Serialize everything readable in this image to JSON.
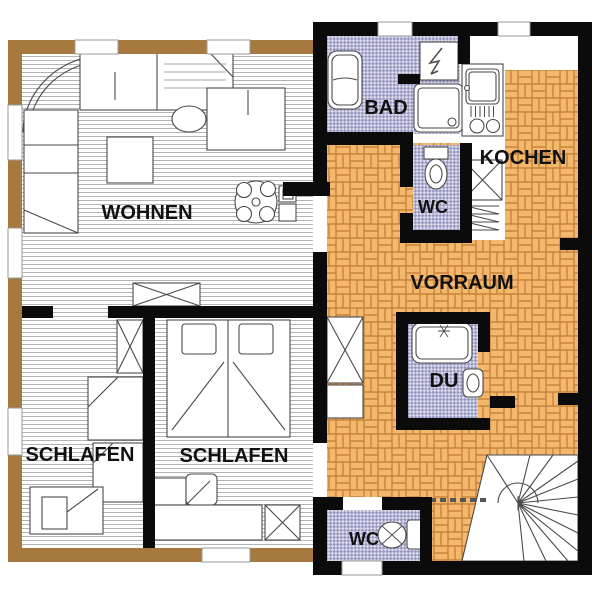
{
  "plan": {
    "rooms": {
      "wohnen": {
        "label": "WOHNEN",
        "floor": "wood"
      },
      "schlafen_left": {
        "label": "SCHLAFEN",
        "floor": "wood"
      },
      "schlafen_right": {
        "label": "SCHLAFEN",
        "floor": "wood"
      },
      "bad": {
        "label": "BAD",
        "floor": "tile"
      },
      "wc_upper": {
        "label": "WC",
        "floor": "tile"
      },
      "kochen": {
        "label": "KOCHEN",
        "floor": "brick"
      },
      "vorraum": {
        "label": "VORRAUM",
        "floor": "brick"
      },
      "du": {
        "label": "DU",
        "floor": "tile"
      },
      "wc_lower": {
        "label": "WC",
        "floor": "tile"
      }
    },
    "colors": {
      "wall_brown": "#A6793F",
      "wall_black": "#0b0b0b",
      "brick_fill": "#F4B86D",
      "brick_line": "#C8823C",
      "tile_base": "#9496C1",
      "tile_light": "#DADAE9",
      "wood_line": "#b3b3b3",
      "label_text": "#111111"
    }
  }
}
